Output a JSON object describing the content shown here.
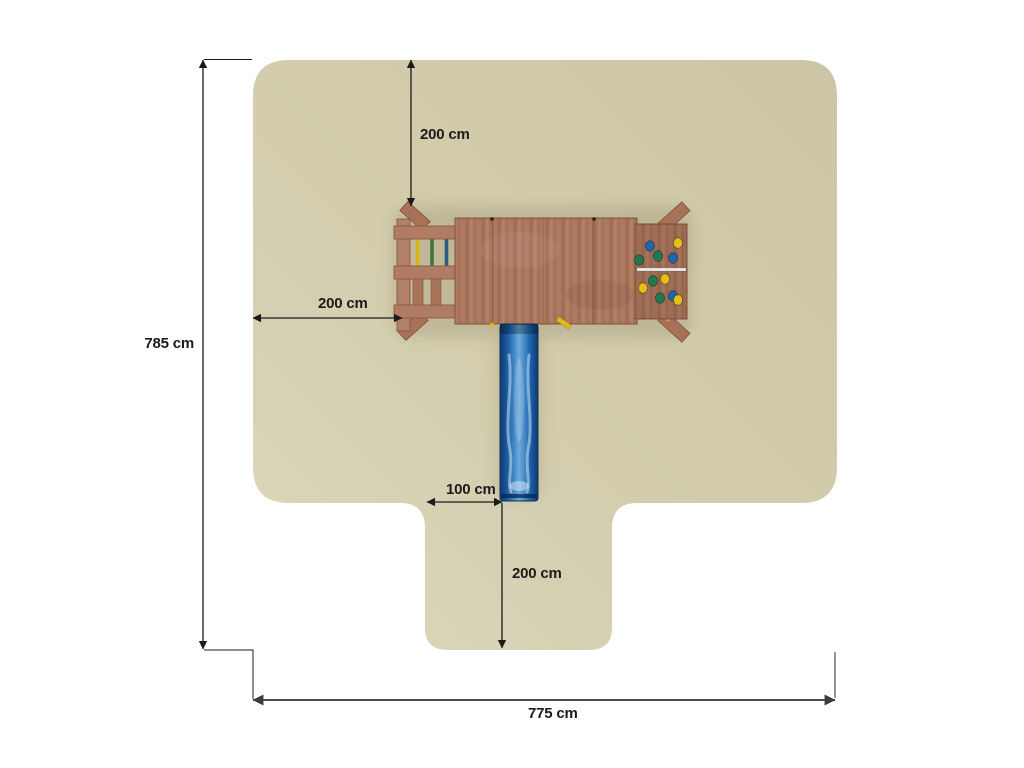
{
  "diagram": {
    "title": "playground-safety-zone-top-view",
    "dimensions": {
      "total_height": "785 cm",
      "clearance_top": "200 cm",
      "clearance_left": "200 cm",
      "slide_offset": "100 cm",
      "slide_exit_clearance": "200 cm",
      "total_width": "775 cm"
    },
    "colors": {
      "safety_zone": "#d3cdae",
      "wood": "#aa775e",
      "slide_blue": "#2e6fb0",
      "hold_blue": "#1f66ad",
      "hold_green": "#207a50",
      "hold_yellow": "#e6be17",
      "dimension_line": "#1b1b1b"
    }
  },
  "playset": {
    "ladder": {
      "rung_colors": [
        "#d9b511",
        "#44763a",
        "#2d5e7e"
      ]
    },
    "climbing_wall": {
      "holds": [
        {
          "x": 650,
          "y": 246,
          "color": "#1f66ad"
        },
        {
          "x": 678,
          "y": 243,
          "color": "#e6be17"
        },
        {
          "x": 639,
          "y": 260,
          "color": "#207a50"
        },
        {
          "x": 658,
          "y": 256,
          "color": "#207a50"
        },
        {
          "x": 673,
          "y": 258,
          "color": "#1f66ad"
        },
        {
          "x": 653,
          "y": 281,
          "color": "#207a50"
        },
        {
          "x": 665,
          "y": 279,
          "color": "#e6be17"
        },
        {
          "x": 643,
          "y": 288,
          "color": "#e6be17"
        },
        {
          "x": 660,
          "y": 298,
          "color": "#207a50"
        },
        {
          "x": 673,
          "y": 296,
          "color": "#1f66ad"
        },
        {
          "x": 678,
          "y": 300,
          "color": "#e6be17"
        }
      ]
    }
  }
}
